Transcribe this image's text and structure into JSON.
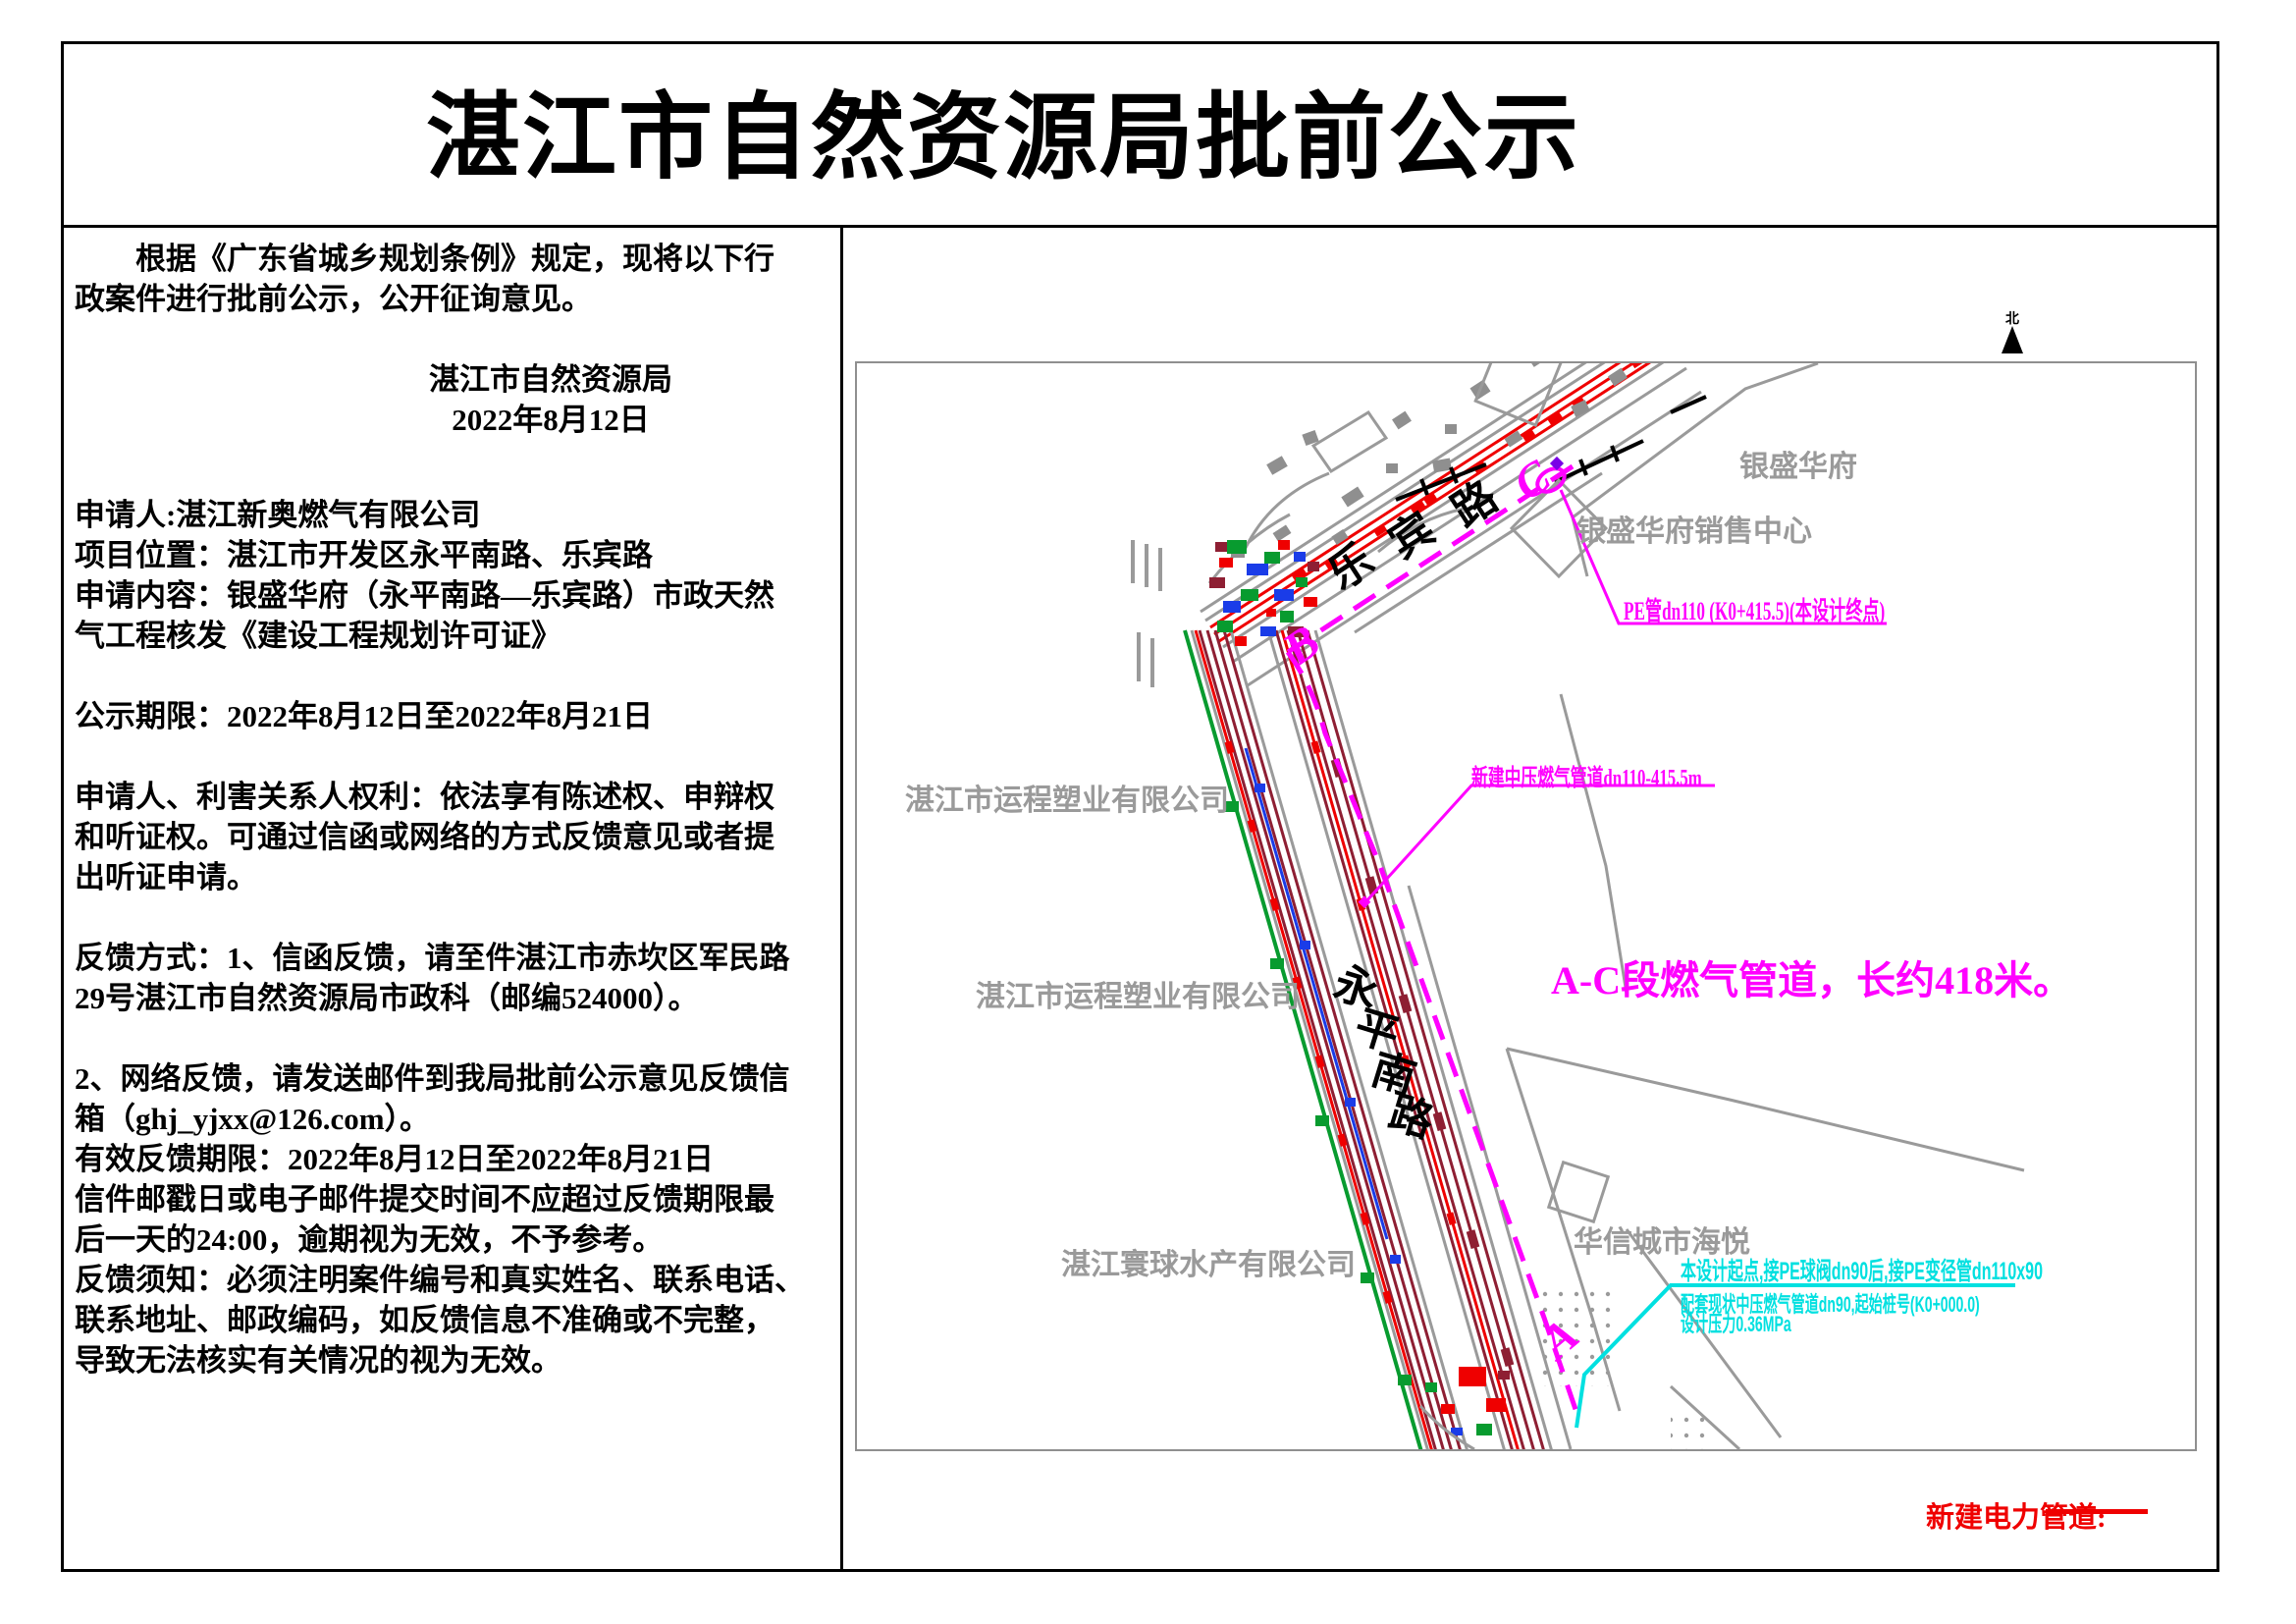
{
  "page": {
    "title": "湛江市自然资源局批前公示"
  },
  "notice": {
    "intro": "　　根据《广东省城乡规划条例》规定，现将以下行\n政案件进行批前公示，公开征询意见。",
    "sign_agency": "湛江市自然资源局",
    "sign_date": "2022年8月12日",
    "application": "申请人:湛江新奥燃气有限公司\n项目位置：湛江市开发区永平南路、乐宾路\n申请内容：银盛华府（永平南路—乐宾路）市政天然\n气工程核发《建设工程规划许可证》",
    "period": "公示期限：2022年8月12日至2022年8月21日",
    "rights": "申请人、利害关系人权利：依法享有陈述权、申辩权\n和听证权。可通过信函或网络的方式反馈意见或者提\n出听证申请。",
    "feedback_mail": "反馈方式：1、信函反馈，请至件湛江市赤坎区军民路\n29号湛江市自然资源局市政科（邮编524000）。",
    "feedback_online": "2、网络反馈，请发送邮件到我局批前公示意见反馈信\n箱（ghj_yjxx@126.com）。\n有效反馈期限：2022年8月12日至2022年8月21日\n信件邮戳日或电子邮件提交时间不应超过反馈期限最\n后一天的24:00，逾期视为无效，不予参考。\n反馈须知：必须注明案件编号和真实姓名、联系电话、\n联系地址、邮政编码，如反馈信息不准确或不完整，\n导致无法核实有关情况的视为无效。"
  },
  "map": {
    "north_label": "北",
    "roads": {
      "lebin": "乐宾路",
      "yongping": "永平南路"
    },
    "points": {
      "a": "A",
      "b": "B",
      "c": "C"
    },
    "labels": {
      "yinsheng": "银盛华府",
      "yinsheng_sales": "银盛华府销售中心",
      "yuncheng1": "湛江市运程塑业有限公司",
      "yuncheng2": "湛江市运程塑业有限公司",
      "huanqiu": "湛江寰球水产有限公司",
      "huaxin": "华信城市海悦",
      "pipe_end": "PE管dn110 (K0+415.5)(本设计终点)",
      "pipe_mid": "新建中压燃气管道dn110-415.5m",
      "segment_note": "A-C段燃气管道，长约418米。",
      "start_line1": "本设计起点,接PE球阀dn90后,接PE变径管dn110x90",
      "start_line2": "配套现状中压燃气管道dn90,起始桩号(K0+000.0)",
      "start_line3": "设计压力0.36MPa"
    },
    "legend": {
      "power_label": "新建电力管道:"
    }
  },
  "colors": {
    "magenta": "#ff00ff",
    "cyan": "#00e0e0",
    "red": "#ef0000",
    "maroon": "#8e1f33",
    "green": "#089b2f",
    "blue": "#1a3ce8",
    "gray": "#9a9a9a"
  }
}
